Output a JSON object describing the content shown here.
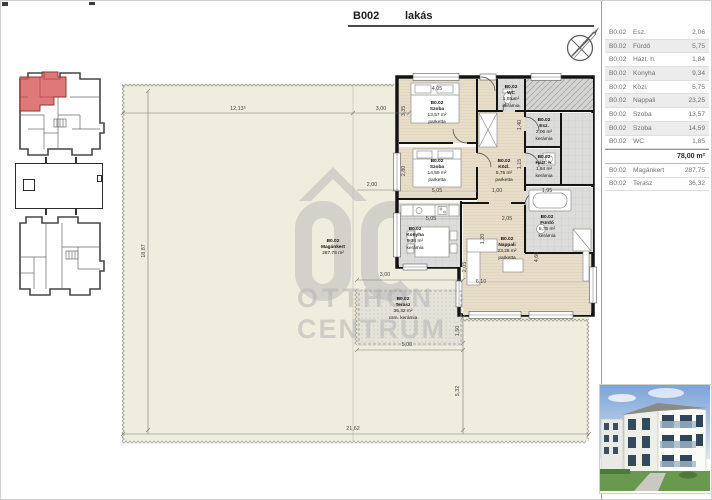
{
  "header": {
    "code": "B002",
    "type_label": "lakás"
  },
  "table": {
    "rows": [
      {
        "code": "B0.02",
        "name": "Esz.",
        "area": "2,06"
      },
      {
        "code": "B0.02",
        "name": "Fürdő",
        "area": "5,75"
      },
      {
        "code": "B0.02",
        "name": "Házt. h.",
        "area": "1,84"
      },
      {
        "code": "B0.02",
        "name": "Konyha",
        "area": "9,34"
      },
      {
        "code": "B0.02",
        "name": "Közl.",
        "area": "5,75"
      },
      {
        "code": "B0.02",
        "name": "Nappali",
        "area": "23,25"
      },
      {
        "code": "B0.02",
        "name": "Szoba",
        "area": "13,57"
      },
      {
        "code": "B0.02",
        "name": "Szoba",
        "area": "14,59"
      },
      {
        "code": "B0.02",
        "name": "WC",
        "area": "1,85"
      }
    ],
    "total": "78,00 m²",
    "extra_rows": [
      {
        "code": "B0.02",
        "name": "Magánkert",
        "area": "287,75"
      },
      {
        "code": "B0.02",
        "name": "Terasz",
        "area": "36,32"
      }
    ]
  },
  "watermark": {
    "line1": "OTTHON",
    "line2": "CENTRUM"
  },
  "plan": {
    "rooms": [
      {
        "code": "B0.02",
        "name": "Szoba",
        "area": "13,57 m²",
        "floor": "parketta",
        "x": 436,
        "y": 100
      },
      {
        "code": "B0.02",
        "name": "Szoba",
        "area": "14,59 m²",
        "floor": "parketta",
        "x": 436,
        "y": 158
      },
      {
        "code": "B0.02",
        "name": "Konyha",
        "area": "9,34 m²",
        "floor": "kerámia",
        "x": 414,
        "y": 226
      },
      {
        "code": "B0.02",
        "name": "Nappali",
        "area": "23,25 m²",
        "floor": "parketta",
        "x": 506,
        "y": 236
      },
      {
        "code": "B0.02",
        "name": "Közl.",
        "area": "5,75 m²",
        "floor": "parketta",
        "x": 503,
        "y": 158
      },
      {
        "code": "B0.02",
        "name": "WC",
        "area": "1,85 m²",
        "floor": "kerámia",
        "x": 510,
        "y": 84
      },
      {
        "code": "B0.02",
        "name": "Esz.",
        "area": "2,06 m²",
        "floor": "kerámia",
        "x": 543,
        "y": 117
      },
      {
        "code": "B0.02",
        "name": "Házt. h.",
        "area": "1,84 m²",
        "floor": "kerámia",
        "x": 543,
        "y": 154
      },
      {
        "code": "B0.02",
        "name": "Fürdő",
        "area": "5,75 m²",
        "floor": "kerámia",
        "x": 546,
        "y": 214
      },
      {
        "code": "B0.02",
        "name": "Terasz",
        "area": "36,32 m²",
        "floor": "csm. kerámia",
        "x": 402,
        "y": 296
      },
      {
        "code": "B0.02",
        "name": "Magánkert",
        "area": "287,75 m²",
        "floor": "",
        "x": 332,
        "y": 238
      }
    ],
    "dims": [
      {
        "t": "12,13⁵",
        "x": 237,
        "y": 108
      },
      {
        "t": "3,00",
        "x": 380,
        "y": 108
      },
      {
        "t": "18,87",
        "x": 143,
        "y": 250,
        "v": 1
      },
      {
        "t": "2,00",
        "x": 371,
        "y": 184
      },
      {
        "t": "3,00",
        "x": 384,
        "y": 274
      },
      {
        "t": "5,00",
        "x": 406,
        "y": 344
      },
      {
        "t": "21,62",
        "x": 352,
        "y": 428
      },
      {
        "t": "5,32",
        "x": 457,
        "y": 390,
        "v": 1
      },
      {
        "t": "1,50",
        "x": 457,
        "y": 330,
        "v": 1
      },
      {
        "t": "4,05",
        "x": 436,
        "y": 88
      },
      {
        "t": "3,35",
        "x": 403,
        "y": 110,
        "v": 1
      },
      {
        "t": "5,05",
        "x": 436,
        "y": 190
      },
      {
        "t": "2,80",
        "x": 403,
        "y": 170,
        "v": 1
      },
      {
        "t": "1,00",
        "x": 496,
        "y": 190
      },
      {
        "t": "1,95",
        "x": 546,
        "y": 190
      },
      {
        "t": "5,05",
        "x": 430,
        "y": 218
      },
      {
        "t": "2,05",
        "x": 506,
        "y": 218
      },
      {
        "t": "6,10",
        "x": 480,
        "y": 281
      },
      {
        "t": "4,60",
        "x": 536,
        "y": 256,
        "v": 1
      },
      {
        "t": "1,20",
        "x": 482,
        "y": 238,
        "v": 1
      },
      {
        "t": "2,05",
        "x": 464,
        "y": 266,
        "v": 1
      },
      {
        "t": "1,40",
        "x": 519,
        "y": 124,
        "v": 1
      },
      {
        "t": "1,15",
        "x": 519,
        "y": 163,
        "v": 1
      }
    ]
  }
}
